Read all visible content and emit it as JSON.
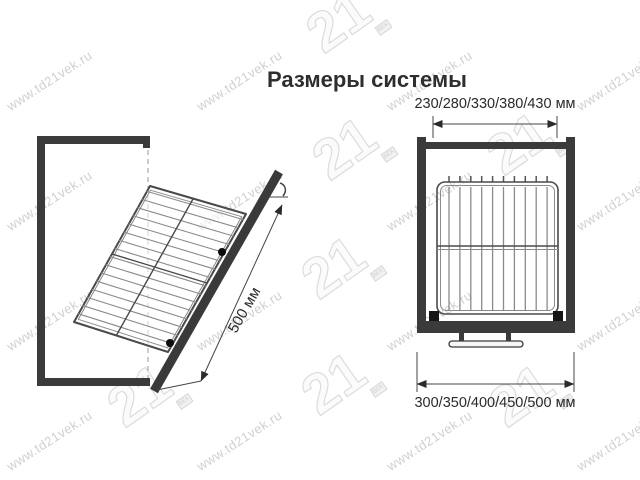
{
  "title": "Размеры системы",
  "watermark": {
    "text": "www.td21vek.ru",
    "logo_text": "21",
    "logo_box_text": "ВЕК",
    "text_color": "#d0d0d0"
  },
  "figures": {
    "left": {
      "name": "side-view-tilted-basket",
      "dimension_label": "500 мм"
    },
    "right": {
      "name": "front-view-basket-in-cabinet",
      "top_dimension_label": "230/280/330/380/430 мм",
      "bottom_dimension_label": "300/350/400/450/500 мм"
    }
  },
  "colors": {
    "cabinet": "#3b3b3b",
    "wire": "#8a8a8a",
    "frame": "#4a4a4a",
    "dimension": "#2b2b2b"
  }
}
